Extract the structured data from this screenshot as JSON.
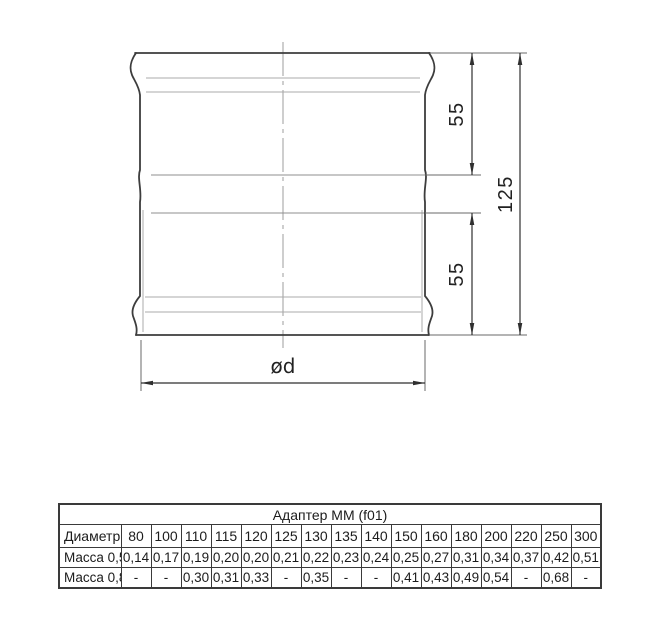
{
  "drawing": {
    "dim_upper": "55",
    "dim_lower": "55",
    "dim_total": "125",
    "dim_diameter": "ød"
  },
  "table": {
    "title": "Адаптер ММ (f01)",
    "diameter": {
      "label": "Диаметр",
      "values": [
        "80",
        "100",
        "110",
        "115",
        "120",
        "125",
        "130",
        "135",
        "140",
        "150",
        "160",
        "180",
        "200",
        "220",
        "250",
        "300"
      ]
    },
    "mass05": {
      "label": "Масса 0,5",
      "values": [
        "0,14",
        "0,17",
        "0,19",
        "0,20",
        "0,20",
        "0,21",
        "0,22",
        "0,23",
        "0,24",
        "0,25",
        "0,27",
        "0,31",
        "0,34",
        "0,37",
        "0,42",
        "0,51"
      ]
    },
    "mass08": {
      "label": "Масса 0,8",
      "values": [
        "-",
        "-",
        "0,30",
        "0,31",
        "0,33",
        "-",
        "0,35",
        "-",
        "-",
        "0,41",
        "0,43",
        "0,49",
        "0,54",
        "-",
        "0,68",
        "-"
      ]
    }
  }
}
